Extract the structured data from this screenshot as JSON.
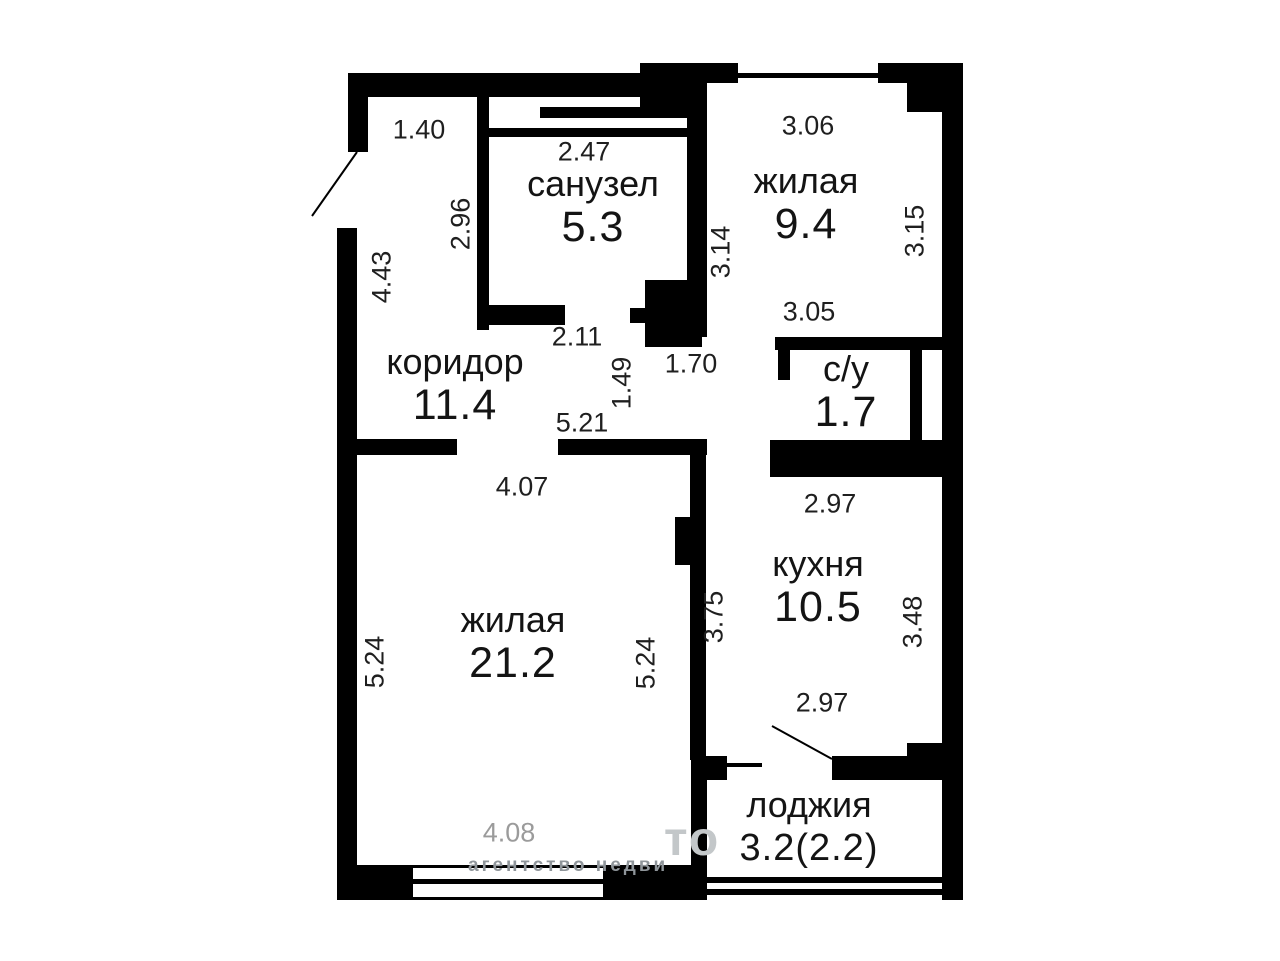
{
  "plan_title": "apartment floor plan",
  "colors": {
    "wall": "#000000",
    "background": "#ffffff",
    "label_text": "#141414",
    "dimension_text": "#1f1f1f",
    "muted_dimension_text": "#9b9b9b",
    "watermark_big": "#c3c7c9",
    "watermark_small": "#8f959a"
  },
  "rooms": [
    {
      "name": "санузел",
      "area": "5.3",
      "cx": 593,
      "y": 164
    },
    {
      "name": "жилая",
      "area": "9.4",
      "cx": 806,
      "y": 161
    },
    {
      "name": "коридор",
      "area": "11.4",
      "cx": 455,
      "y": 342
    },
    {
      "name": "с/у",
      "area": "1.7",
      "cx": 846,
      "y": 349
    },
    {
      "name": "кухня",
      "area": "10.5",
      "cx": 818,
      "y": 544
    },
    {
      "name": "жилая",
      "area": "21.2",
      "cx": 513,
      "y": 600
    },
    {
      "name": "лоджия",
      "area": "3.2(2.2)",
      "cx": 809,
      "y": 785,
      "area_size": 38
    }
  ],
  "dimensions": [
    {
      "text": "1.40",
      "x": 419,
      "y": 130,
      "orient": "h"
    },
    {
      "text": "2.47",
      "x": 584,
      "y": 152,
      "orient": "h"
    },
    {
      "text": "3.06",
      "x": 808,
      "y": 126,
      "orient": "h"
    },
    {
      "text": "2.96",
      "x": 461,
      "y": 224,
      "orient": "v"
    },
    {
      "text": "3.15",
      "x": 915,
      "y": 231,
      "orient": "v"
    },
    {
      "text": "3.14",
      "x": 721,
      "y": 252,
      "orient": "v"
    },
    {
      "text": "4.43",
      "x": 382,
      "y": 277,
      "orient": "v"
    },
    {
      "text": "3.05",
      "x": 809,
      "y": 312,
      "orient": "h"
    },
    {
      "text": "2.11",
      "x": 577,
      "y": 337,
      "orient": "h"
    },
    {
      "text": "1.70",
      "x": 691,
      "y": 364,
      "orient": "h"
    },
    {
      "text": "1.49",
      "x": 622,
      "y": 383,
      "orient": "v"
    },
    {
      "text": "5.21",
      "x": 582,
      "y": 423,
      "orient": "h"
    },
    {
      "text": "4.07",
      "x": 522,
      "y": 487,
      "orient": "h"
    },
    {
      "text": "2.97",
      "x": 830,
      "y": 504,
      "orient": "h"
    },
    {
      "text": "3.75",
      "x": 714,
      "y": 617,
      "orient": "v"
    },
    {
      "text": "3.48",
      "x": 913,
      "y": 622,
      "orient": "v"
    },
    {
      "text": "5.24",
      "x": 375,
      "y": 662,
      "orient": "v"
    },
    {
      "text": "5.24",
      "x": 646,
      "y": 663,
      "orient": "v"
    },
    {
      "text": "2.97",
      "x": 822,
      "y": 703,
      "orient": "h"
    },
    {
      "text": "4.08",
      "x": 509,
      "y": 833,
      "orient": "h",
      "muted": true
    }
  ],
  "watermark": {
    "big_fragment": "то",
    "small_fragment": "агентство недви"
  }
}
